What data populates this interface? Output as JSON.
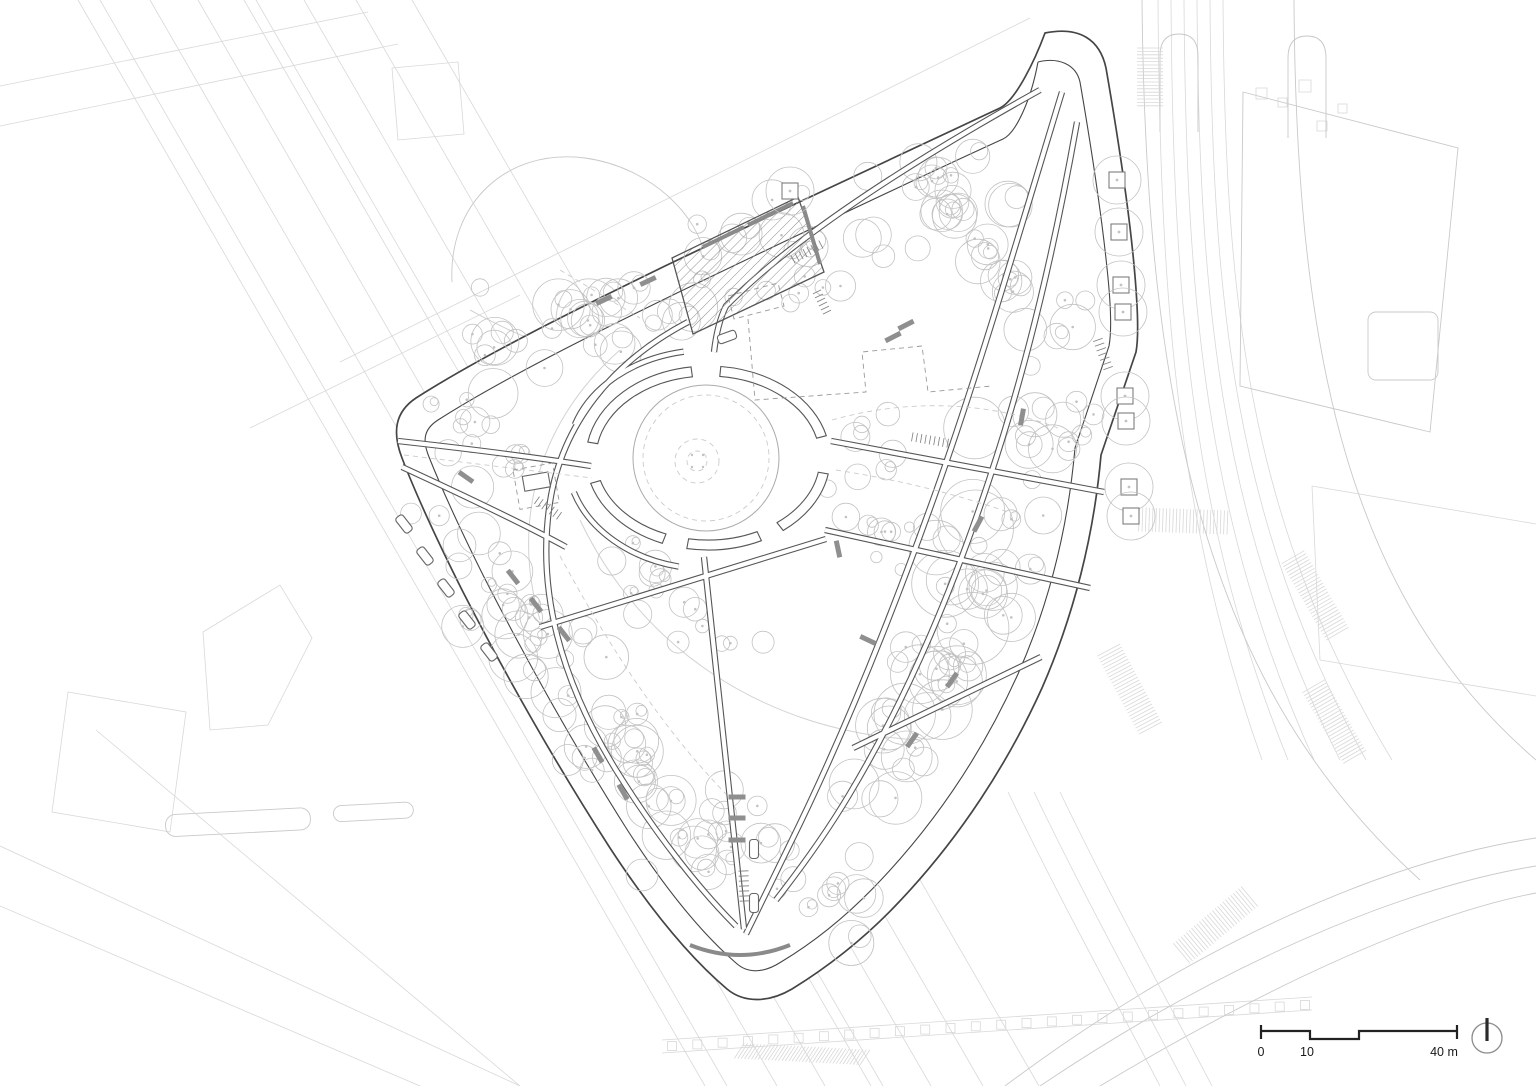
{
  "document": {
    "type": "architectural-site-plan",
    "description": "Site plan of a triangular public park with a central oval plaza, tree planting, path network and surrounding streets"
  },
  "scale_bar": {
    "tick_zero": "0",
    "tick_ten": "10",
    "tick_forty": "40 m"
  },
  "north_arrow": {
    "symbol": "circle-with-needle"
  },
  "colors": {
    "background": "#ffffff",
    "context": "#d8d8d8",
    "context_dark": "#c9c9c9",
    "outline": "#454545",
    "path": "#565656",
    "tree": "#c2c2c2",
    "dashed": "#9a9a9a",
    "furniture": "#8f8f8f",
    "text": "#1a1a1a"
  },
  "drawing": {
    "tree_clusters": [
      [
        470,
        355,
        890,
        218,
        65,
        52,
        7,
        26,
        11
      ],
      [
        915,
        165,
        1075,
        340,
        60,
        34,
        7,
        24,
        22
      ],
      [
        1058,
        385,
        972,
        618,
        54,
        28,
        8,
        26,
        33
      ],
      [
        972,
        618,
        862,
        828,
        54,
        28,
        8,
        30,
        44
      ],
      [
        435,
        485,
        685,
        855,
        62,
        55,
        7,
        26,
        55
      ],
      [
        690,
        812,
        878,
        915,
        52,
        26,
        8,
        24,
        66
      ],
      [
        848,
        420,
        948,
        628,
        66,
        18,
        5,
        15,
        77
      ],
      [
        600,
        562,
        756,
        658,
        38,
        15,
        6,
        17,
        88
      ],
      [
        985,
        425,
        918,
        735,
        46,
        8,
        26,
        44,
        99
      ],
      [
        432,
        402,
        520,
        468,
        38,
        12,
        6,
        17,
        12
      ]
    ],
    "planters": [
      [
        1117,
        180
      ],
      [
        1119,
        232
      ],
      [
        1121,
        285
      ],
      [
        1123,
        312
      ],
      [
        1125,
        396
      ],
      [
        1126,
        421
      ],
      [
        1129,
        487
      ],
      [
        1131,
        516
      ],
      [
        790,
        191
      ]
    ],
    "benches_gray": [
      [
        1022,
        417,
        -80
      ],
      [
        978,
        524,
        -62
      ],
      [
        893,
        337,
        -27
      ],
      [
        906,
        325,
        -27
      ],
      [
        838,
        549,
        78
      ],
      [
        513,
        577,
        52
      ],
      [
        536,
        605,
        52
      ],
      [
        564,
        634,
        52
      ],
      [
        466,
        477,
        35
      ],
      [
        604,
        300,
        -25
      ],
      [
        648,
        281,
        -25
      ],
      [
        737,
        797,
        0
      ],
      [
        737,
        818,
        0
      ],
      [
        737,
        840,
        0
      ],
      [
        952,
        680,
        -55
      ],
      [
        912,
        740,
        -55
      ],
      [
        868,
        640,
        25
      ],
      [
        598,
        755,
        60
      ],
      [
        623,
        792,
        60
      ]
    ],
    "benches_white": [
      [
        404,
        524,
        52
      ],
      [
        425,
        556,
        52
      ],
      [
        446,
        588,
        52
      ],
      [
        467,
        620,
        52
      ],
      [
        489,
        652,
        52
      ],
      [
        754,
        849,
        90
      ],
      [
        754,
        903,
        90
      ],
      [
        727,
        337,
        -20
      ]
    ],
    "stair_ticks": [
      [
        807,
        252,
        -28,
        8,
        4.5,
        9
      ],
      [
        930,
        440,
        10,
        9,
        4.5,
        9
      ],
      [
        548,
        508,
        35,
        7,
        4.5,
        9
      ],
      [
        1103,
        354,
        70,
        7,
        5,
        10
      ],
      [
        744,
        886,
        88,
        7,
        5,
        10
      ],
      [
        822,
        302,
        64,
        6,
        4.5,
        9
      ]
    ],
    "crosswalks": [
      [
        1150,
        80,
        64,
        26,
        90,
        0
      ],
      [
        1185,
        521,
        92,
        24,
        2,
        0
      ],
      [
        1131,
        692,
        95,
        26,
        62,
        0
      ],
      [
        1316,
        597,
        92,
        26,
        60,
        0
      ],
      [
        1335,
        723,
        85,
        26,
        60,
        0
      ],
      [
        1213,
        927,
        95,
        26,
        140,
        0
      ],
      [
        800,
        1054,
        130,
        18,
        183,
        30
      ]
    ],
    "colonnade": {
      "x1": 672,
      "y1": 1046,
      "x2": 1305,
      "y2": 1005,
      "count": 26,
      "size": 9
    }
  }
}
